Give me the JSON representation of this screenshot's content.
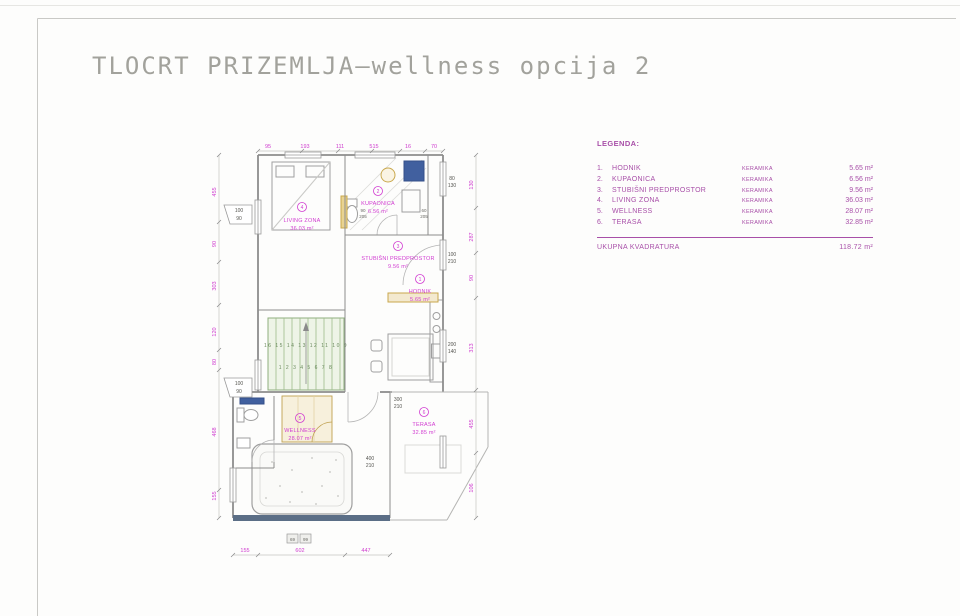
{
  "page": {
    "title": "TLOCRT PRIZEMLJA–wellness opcija 2"
  },
  "legend": {
    "heading": "LEGENDA:",
    "items": [
      {
        "num": "1.",
        "name": "HODNIK",
        "finish": "KERAMIKA",
        "area": "5.65 m²"
      },
      {
        "num": "2.",
        "name": "KUPAONICA",
        "finish": "KERAMIKA",
        "area": "6.56 m²"
      },
      {
        "num": "3.",
        "name": "STUBIŠNI PREDPROSTOR",
        "finish": "KERAMIKA",
        "area": "9.56 m²"
      },
      {
        "num": "4.",
        "name": "LIVING ZONA",
        "finish": "KERAMIKA",
        "area": "36.03 m²"
      },
      {
        "num": "5.",
        "name": "WELLNESS",
        "finish": "KERAMIKA",
        "area": "28.07 m²"
      },
      {
        "num": "6.",
        "name": "TERASA",
        "finish": "KERAMIKA",
        "area": "32.85 m²"
      }
    ],
    "total_label": "UKUPNA KVADRATURA",
    "total_area": "118.72 m²"
  },
  "plan": {
    "rooms": [
      {
        "num": "4",
        "name": "LIVING ZONA",
        "area": "36.03 m²"
      },
      {
        "num": "2",
        "name": "KUPAONICA",
        "area": "6.56 m²"
      },
      {
        "num": "3",
        "name": "STUBIŠNI PREDPROSTOR",
        "area": "9.56 m²"
      },
      {
        "num": "1",
        "name": "HODNIK",
        "area": "5.65 m²"
      },
      {
        "num": "5",
        "name": "WELLNESS",
        "area": "28.07 m²"
      },
      {
        "num": "6",
        "name": "TERASA",
        "area": "32.85 m²"
      }
    ],
    "dims": {
      "top": [
        "95",
        "193",
        "111",
        "515",
        "16",
        "70"
      ],
      "left": [
        "455",
        "90",
        "303",
        "120",
        "80",
        "468",
        "155"
      ],
      "right": [
        "130",
        "287",
        "90",
        "313",
        "455",
        "106"
      ],
      "bottom": [
        "155",
        "602",
        "447"
      ]
    },
    "window_tags": [
      {
        "w": "80",
        "h": "130"
      },
      {
        "w": "100",
        "h": "210"
      },
      {
        "w": "200",
        "h": "140"
      },
      {
        "w": "300",
        "h": "210"
      },
      {
        "w": "400",
        "h": "210"
      },
      {
        "w": "100",
        "h": "90"
      },
      {
        "w": "100",
        "h": "90"
      }
    ],
    "door_tags": [
      {
        "w": "90",
        "h": "205"
      },
      {
        "w": "60",
        "h": "205"
      }
    ],
    "bottom_tags": [
      "69",
      "99"
    ],
    "stairs": {
      "row1": "16 15 14 13 12 11 10 9",
      "row2": "1 2 3 4 5 6 7 8"
    }
  },
  "colors": {
    "annotation_magenta": "#d13cd1",
    "legend_magenta": "#a84fa8",
    "wall_gray": "#8d8d8d",
    "stairs_green": "#8fae7e",
    "wood_tan": "#c9a84c",
    "fixture_blue": "#41609f",
    "glass_wall_dark": "#5b6e86"
  }
}
